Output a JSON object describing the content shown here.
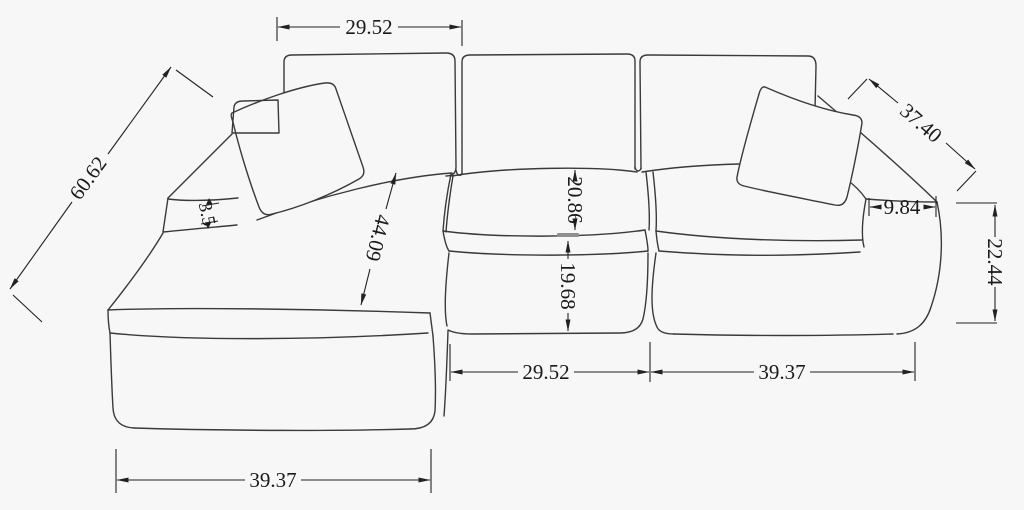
{
  "dims": {
    "top_width": "29.52",
    "left_depth": "60.62",
    "arm_pad": "3.5",
    "chaise_length": "44.09",
    "back_height": "20.86",
    "seat_height": "19.68",
    "right_depth": "37.40",
    "arm_width": "9.84",
    "side_height": "22.44",
    "mid_width": "29.52",
    "right_width": "39.37",
    "chaise_width": "39.37"
  },
  "colors": {
    "background": "#f7f7f7",
    "sofa_line": "#3a3a3a",
    "dimension_line": "#222222",
    "text": "#1a1a1a",
    "highlight_tick": "#8f8f8f"
  }
}
